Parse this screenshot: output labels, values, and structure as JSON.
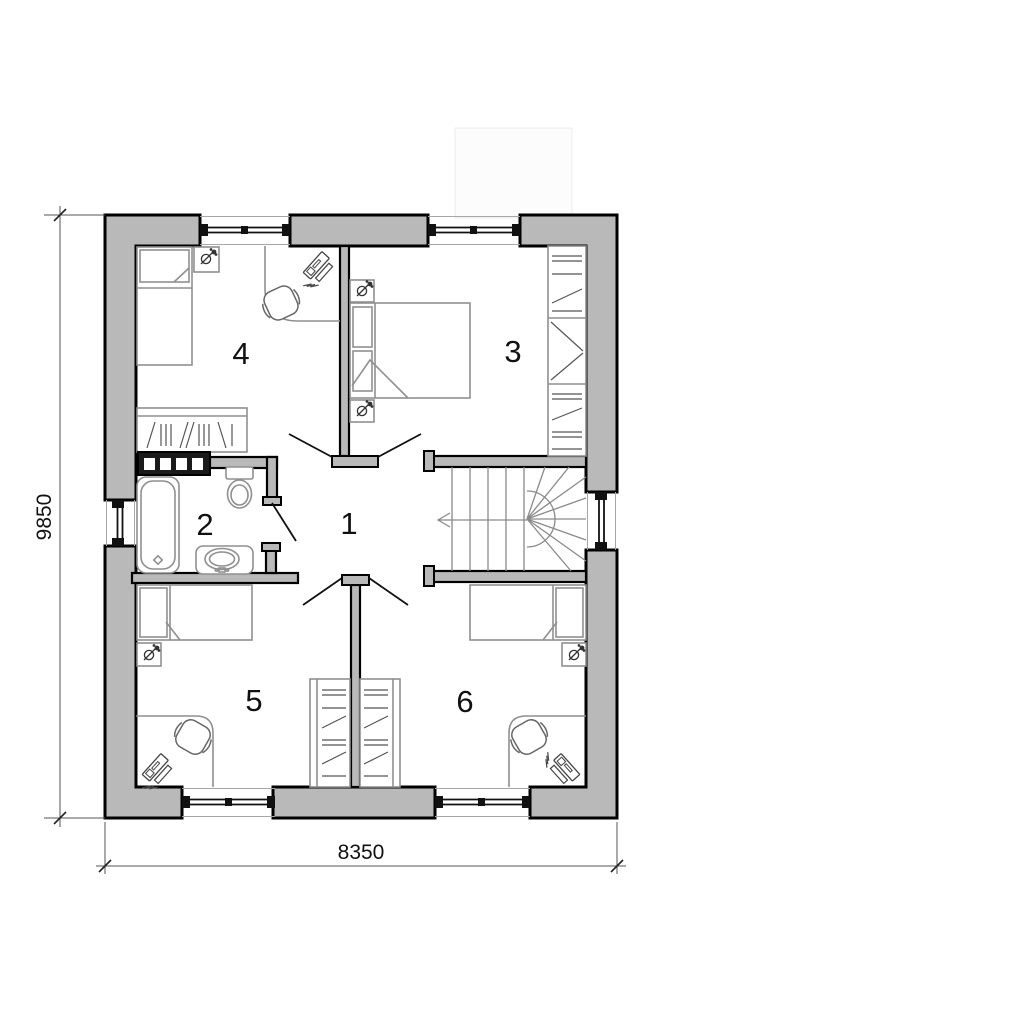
{
  "dimensions": {
    "horizontal_label": "8350",
    "vertical_label": "9850"
  },
  "rooms": [
    {
      "label": "1"
    },
    {
      "label": "2"
    },
    {
      "label": "3"
    },
    {
      "label": "4"
    },
    {
      "label": "5"
    },
    {
      "label": "6"
    }
  ],
  "colors": {
    "wall_fill": "#b9b9b9",
    "wall_outline": "#000000",
    "furniture_stroke": "#8f8f8f",
    "dark_accent": "#1a1a1a",
    "dimension_text": "#111111",
    "background": "#ffffff"
  }
}
